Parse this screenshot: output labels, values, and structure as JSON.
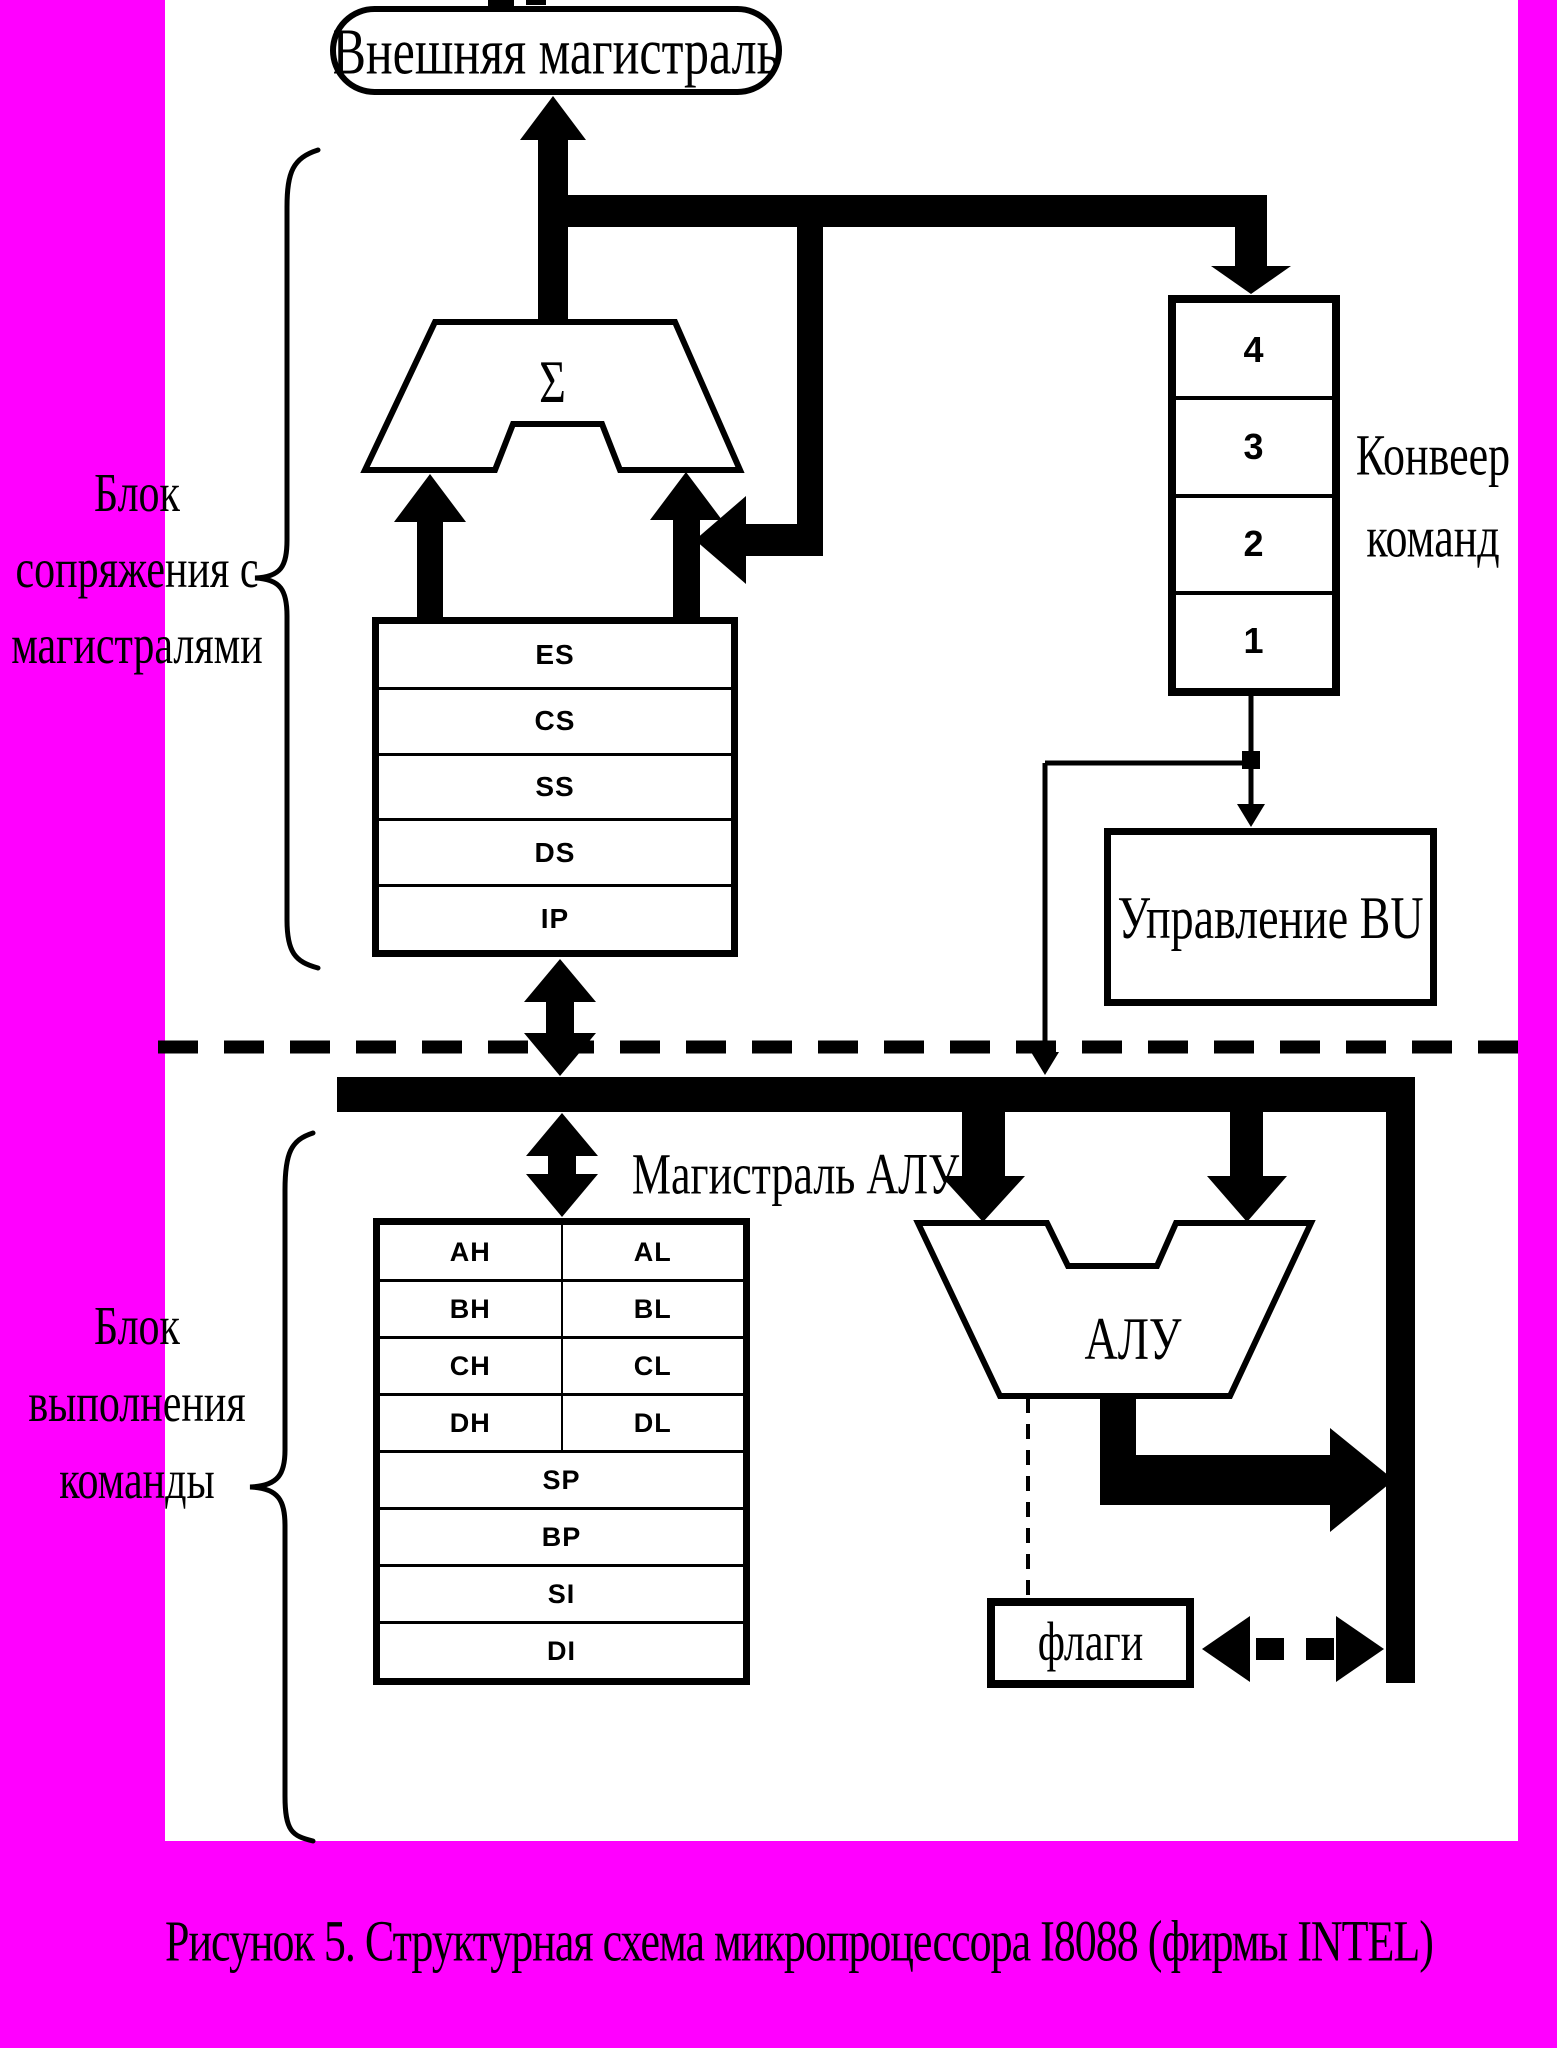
{
  "colors": {
    "page_border": "#ff00ff",
    "canvas": "#ffffff",
    "ink": "#000000"
  },
  "external_bus": {
    "label": "Внешняя магистраль"
  },
  "adder": {
    "symbol": "Σ"
  },
  "segment_registers": {
    "rows": [
      "ES",
      "CS",
      "SS",
      "DS",
      "IP"
    ]
  },
  "instruction_pipeline": {
    "cells": [
      "4",
      "3",
      "2",
      "1"
    ],
    "label": [
      "Конвеер",
      "команд"
    ]
  },
  "bu_control": {
    "label": "Управление BU"
  },
  "alu_bus": {
    "label": "Магистраль АЛУ"
  },
  "execution_registers": {
    "pair_rows": [
      [
        "AH",
        "AL"
      ],
      [
        "BH",
        "BL"
      ],
      [
        "CH",
        "CL"
      ],
      [
        "DH",
        "DL"
      ]
    ],
    "full_rows": [
      "SP",
      "BP",
      "SI",
      "DI"
    ]
  },
  "alu": {
    "label": "АЛУ"
  },
  "flags": {
    "label": "флаги"
  },
  "left_labels": {
    "biu": [
      "Блок",
      "сопряжения с",
      "магистралями"
    ],
    "eu": [
      "Блок",
      "выполнения",
      "команды"
    ]
  },
  "caption": {
    "text": "Рисунок 5.  Структурная схема микропроцессора I8088 (фирмы INTEL)"
  }
}
